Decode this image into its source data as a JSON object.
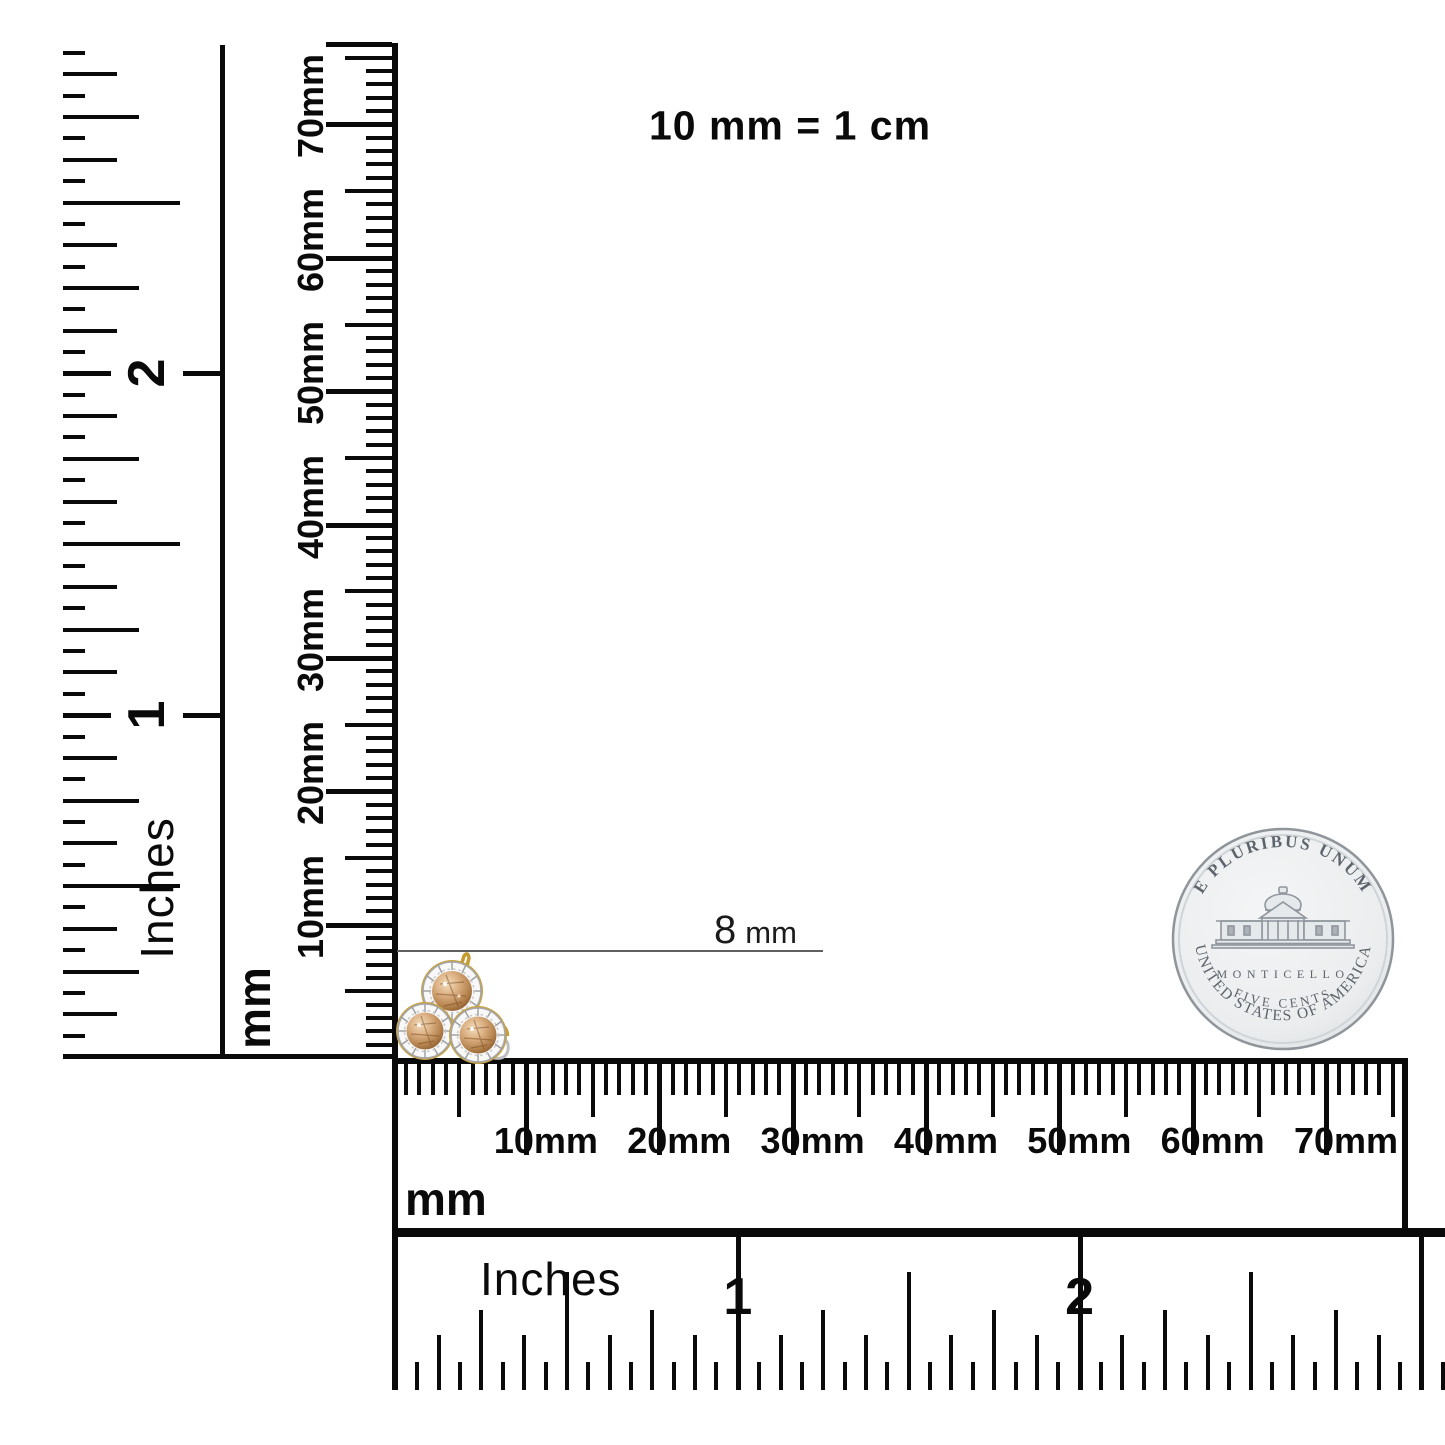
{
  "title": "10 mm = 1 cm",
  "dimension": {
    "value": "8",
    "unit": "mm"
  },
  "rulers": {
    "vertical_mm": {
      "unit": "mm",
      "tick_labels": [
        "10mm",
        "20mm",
        "30mm",
        "40mm",
        "50mm",
        "60mm",
        "70mm"
      ]
    },
    "vertical_inch": {
      "unit": "Inches",
      "tick_labels": [
        "1",
        "2"
      ]
    },
    "horizontal_mm": {
      "unit": "mm",
      "tick_labels": [
        "10mm",
        "20mm",
        "30mm",
        "40mm",
        "50mm",
        "60mm",
        "70mm"
      ]
    },
    "horizontal_inch": {
      "unit": "Inches",
      "tick_labels": [
        "1",
        "2"
      ]
    }
  },
  "coin": {
    "motto": "E PLURIBUS UNUM",
    "building": "MONTICELLO",
    "denomination": "FIVE CENTS",
    "country": "UNITED STATES OF AMERICA"
  },
  "colors": {
    "ink": "#0a0a0a",
    "dimension_line": "#5f5f5f",
    "coin_body": "#edeff0",
    "coin_rim": "#8f959b",
    "coin_text": "#5d646b",
    "earring_gold": "#c79d38",
    "earring_stone": "#c1915c"
  }
}
